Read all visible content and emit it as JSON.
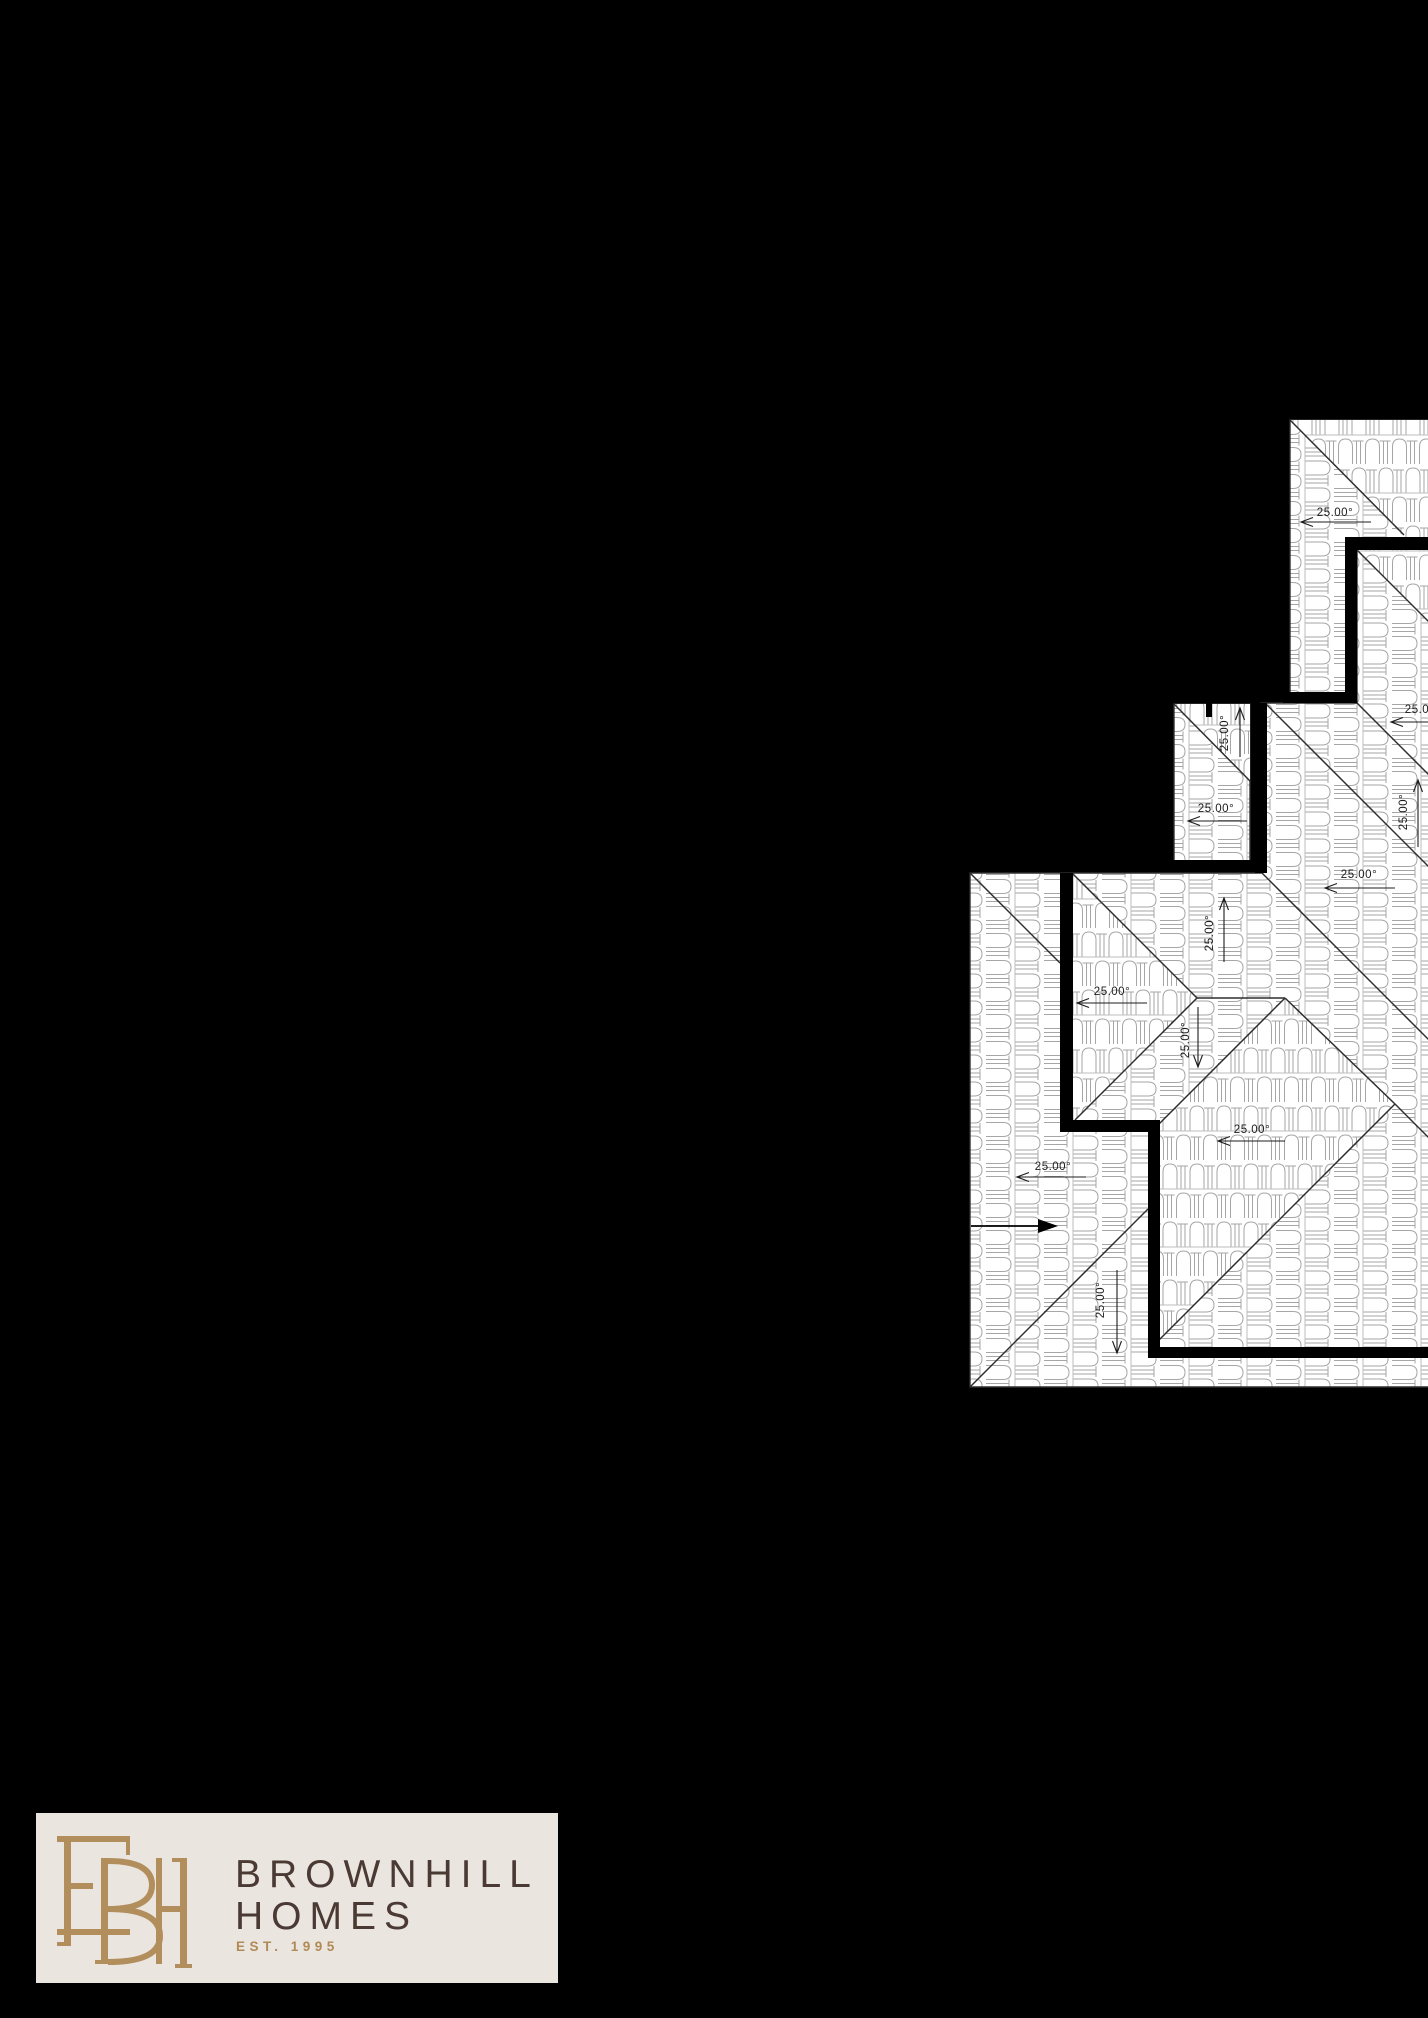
{
  "page": {
    "width": 1428,
    "height": 2018,
    "background": "#000000"
  },
  "roof_plan": {
    "angle_text": "25.00°",
    "colors": {
      "paper": "#ffffff",
      "tile_line": "#a6a6a6",
      "edge_line": "#2e2e2e",
      "wall": "#000000",
      "label": "#1c1c1c"
    },
    "base_regions": [
      "1290,420 1430,420 1430,693 1290,693",
      "1357,550 1430,550 1430,1387 970,1387 970,873 1261,873 1261,703 1357,703",
      "1174,704 1250,704 1250,862 1174,862"
    ],
    "cross_regions": [
      "1290,420 1430,420 1430,537 1404,537",
      "1357,550 1430,550 1430,623",
      "1174,704 1250,704 1250,781",
      "1285,998 1395,1104 1158,1341 1157,1126",
      "1072,873 1197,998 1075,1120 1072,1120"
    ],
    "hip_lines": [
      [
        1290,
        420,
        1404,
        535
      ],
      [
        1357,
        550,
        1430,
        623
      ],
      [
        1357,
        703,
        1430,
        776
      ],
      [
        1174,
        704,
        1250,
        781
      ],
      [
        1267,
        705,
        1430,
        868
      ],
      [
        1260,
        871,
        1430,
        1041
      ],
      [
        970,
        873,
        1060,
        963
      ],
      [
        1072,
        873,
        1197,
        998
      ],
      [
        1197,
        998,
        1285,
        998
      ],
      [
        1197,
        998,
        1075,
        1120
      ],
      [
        1285,
        998,
        1158,
        1125
      ],
      [
        1285,
        998,
        1395,
        1104
      ],
      [
        1395,
        1104,
        1430,
        1139
      ],
      [
        1395,
        1104,
        1158,
        1341
      ],
      [
        970,
        1387,
        1148,
        1209
      ]
    ],
    "walls": [
      [
        1345,
        537,
        85,
        13
      ],
      [
        1345,
        537,
        12,
        166
      ],
      [
        1283,
        692,
        74,
        11
      ],
      [
        1255,
        703,
        12,
        170
      ],
      [
        1170,
        860,
        90,
        12
      ],
      [
        1060,
        873,
        13,
        259
      ],
      [
        1060,
        1120,
        100,
        12
      ],
      [
        1148,
        1120,
        12,
        238
      ],
      [
        1148,
        1347,
        282,
        11
      ]
    ],
    "vent_tick": [
      1206,
      700,
      6,
      17
    ],
    "north_arrow": {
      "x1": 971,
      "y1": 1226,
      "x2": 1040,
      "y2": 1226,
      "head": "1038,1219 1058,1226 1038,1233"
    },
    "dim_labels": [
      {
        "text": "25.00°",
        "x": 1335,
        "y": 516,
        "rot": 0,
        "ax": 1301,
        "ay": 522,
        "bx": 1371,
        "by": 522,
        "dir": "left"
      },
      {
        "text": "25.00°",
        "x": 1423,
        "y": 713,
        "rot": 0,
        "ax": 1391,
        "ay": 722,
        "bx": 1428,
        "by": 722,
        "dir": "left"
      },
      {
        "text": "25.00°",
        "x": 1407,
        "y": 812,
        "rot": -90,
        "ax": 1418,
        "ay": 780,
        "bx": 1418,
        "by": 847,
        "dir": "up"
      },
      {
        "text": "25.00°",
        "x": 1228,
        "y": 733,
        "rot": -90,
        "ax": 1240,
        "ay": 708,
        "bx": 1240,
        "by": 757,
        "dir": "up"
      },
      {
        "text": "25.00°",
        "x": 1216,
        "y": 812,
        "rot": 0,
        "ax": 1188,
        "ay": 821,
        "bx": 1247,
        "by": 821,
        "dir": "left"
      },
      {
        "text": "25.00°",
        "x": 1359,
        "y": 878,
        "rot": 0,
        "ax": 1325,
        "ay": 888,
        "bx": 1395,
        "by": 888,
        "dir": "left"
      },
      {
        "text": "25.00°",
        "x": 1213,
        "y": 933,
        "rot": -90,
        "ax": 1224,
        "ay": 898,
        "bx": 1224,
        "by": 962,
        "dir": "up"
      },
      {
        "text": "25.00°",
        "x": 1112,
        "y": 995,
        "rot": 0,
        "ax": 1077,
        "ay": 1003,
        "bx": 1147,
        "by": 1003,
        "dir": "left"
      },
      {
        "text": "25.00°",
        "x": 1189,
        "y": 1040,
        "rot": -90,
        "ax": 1198,
        "ay": 1007,
        "bx": 1198,
        "by": 1067,
        "dir": "down"
      },
      {
        "text": "25.00°",
        "x": 1053,
        "y": 1170,
        "rot": 0,
        "ax": 1017,
        "ay": 1177,
        "bx": 1086,
        "by": 1177,
        "dir": "left"
      },
      {
        "text": "25.00°",
        "x": 1104,
        "y": 1300,
        "rot": -90,
        "ax": 1117,
        "ay": 1270,
        "bx": 1117,
        "by": 1353,
        "dir": "down"
      },
      {
        "text": "25.00°",
        "x": 1252,
        "y": 1133,
        "rot": 0,
        "ax": 1218,
        "ay": 1141,
        "bx": 1285,
        "by": 1141,
        "dir": "left"
      }
    ]
  },
  "logo": {
    "box_bg": "#ebe5e0",
    "monogram_letters": "BH",
    "monogram_color": "#b28e5c",
    "name_line1": "BROWNHILL",
    "name_line2": "HOMES",
    "tagline": "EST. 1995",
    "name_color": "#4a3a33",
    "tagline_color": "#b08a55"
  }
}
